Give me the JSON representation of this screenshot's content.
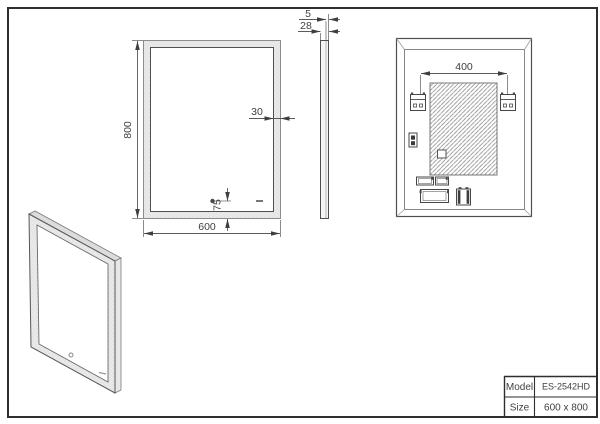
{
  "dimensions": {
    "front_height": "800",
    "front_width": "600",
    "frame_width": "30",
    "sensor_offset": "75",
    "glass_thickness": "5",
    "total_depth": "28",
    "bracket_spacing": "400"
  },
  "title_block": {
    "model_label": "Model",
    "model_value": "ES-2542HD",
    "size_label": "Size",
    "size_value": "600 x 800"
  },
  "colors": {
    "line": "#4f4f4f",
    "dim_line": "#5a5a5a",
    "frame_band": "#e9e9e9",
    "hatch": "#8f8f8f"
  }
}
